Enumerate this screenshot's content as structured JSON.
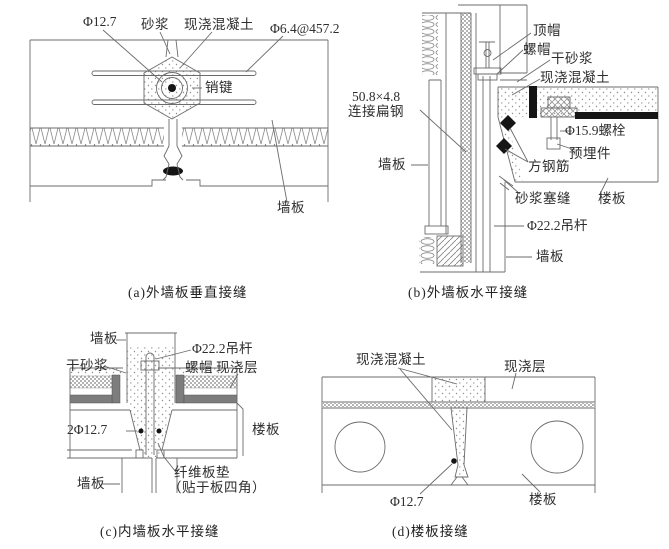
{
  "diagrams": {
    "a": {
      "caption": "(a)外墙板垂直接缝",
      "labels": {
        "bar_dia": "Φ12.7",
        "mortar": "砂浆",
        "cast_in_situ_concrete": "现浇混凝土",
        "tie_bar": "Φ6.4@457.2",
        "shear_key": "销键",
        "wall_panel": "墙板"
      }
    },
    "b": {
      "caption": "(b)外墙板水平接缝",
      "labels": {
        "top_cap": "顶帽",
        "nut": "螺帽",
        "dry_mortar": "干砂浆",
        "cast_in_situ_concrete": "现浇混凝土",
        "flat_steel_size": "50.8×4.8",
        "flat_steel": "连接扁钢",
        "bolt": "Φ15.9螺栓",
        "embedded_part": "预埋件",
        "square_rebar": "方钢筋",
        "wall_panel_left": "墙板",
        "mortar_caulking": "砂浆塞缝",
        "floor_slab": "楼板",
        "hanger_rod": "Φ22.2吊杆",
        "wall_panel_bottom": "墙板"
      }
    },
    "c": {
      "caption": "(c)内墙板水平接缝",
      "labels": {
        "wall_panel_top": "墙板",
        "hanger_rod": "Φ22.2吊杆",
        "dry_mortar": "干砂浆",
        "nut": "螺帽",
        "cast_layer": "现浇层",
        "bars": "2Φ12.7",
        "floor_slab": "楼板",
        "fiber_pad": "纤维板垫",
        "fiber_pad_note": "（贴于板四角）",
        "wall_panel_bottom": "墙板"
      }
    },
    "d": {
      "caption": "(d)楼板接缝",
      "labels": {
        "cast_in_situ_concrete": "现浇混凝土",
        "cast_layer": "现浇层",
        "bar_dia": "Φ12.7",
        "floor_slab": "楼板"
      }
    }
  }
}
